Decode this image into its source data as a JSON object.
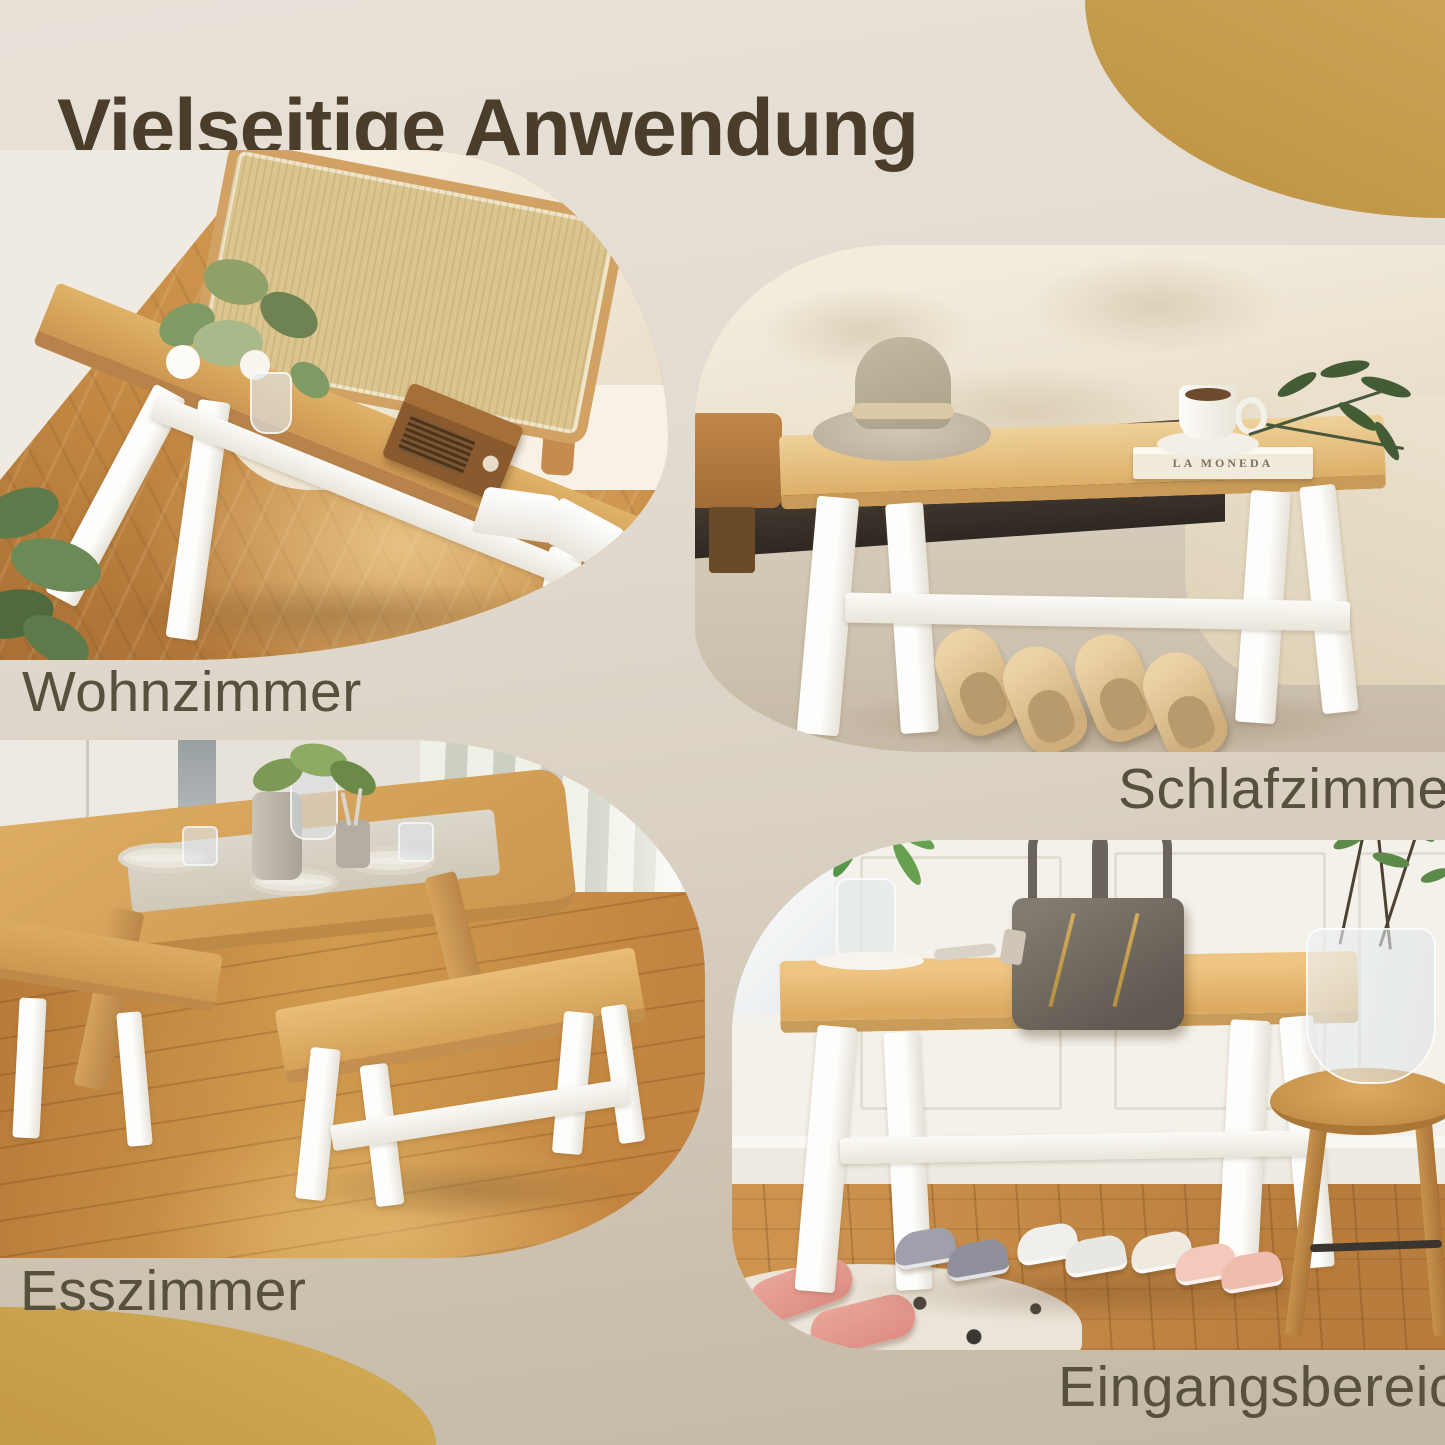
{
  "page": {
    "title": "Vielseitige Anwendung"
  },
  "colors": {
    "background_top": "#e7e1d8",
    "background_bottom": "#c3b8a5",
    "accent_gold": "#c59c4b",
    "title_color": "#4a3e2b",
    "label_color": "#56503c",
    "bench_wood": "#ddaf68",
    "bench_legs_white": "#fdfdfb"
  },
  "panels": [
    {
      "id": "wohnzimmer",
      "label": "Wohnzimmer"
    },
    {
      "id": "schlafzimmer",
      "label": "Schlafzimmer"
    },
    {
      "id": "esszimmer",
      "label": "Esszimmer"
    },
    {
      "id": "eingangsbereich",
      "label": "Eingangsbereich"
    }
  ],
  "photo_texts": {
    "book_spine": "LA MONEDA"
  }
}
